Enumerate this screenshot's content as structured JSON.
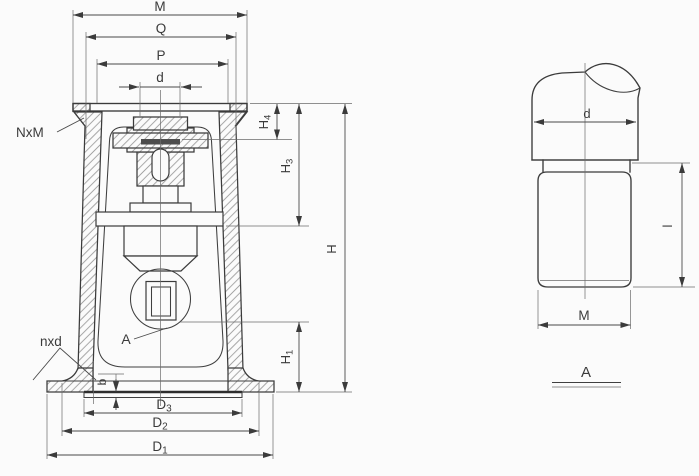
{
  "drawing": {
    "type": "engineering-section-drawing",
    "colors": {
      "background": "#fbfbfb",
      "line": "#3b3b3b",
      "dark_insert": "#4d4d4d",
      "hatch": "#8a8a8a"
    },
    "front_view": {
      "top_dims": {
        "m": "M",
        "q": "Q",
        "p": "P",
        "d": "d"
      },
      "right_dims": {
        "h4": {
          "base": "H",
          "sub": "4"
        },
        "h3": {
          "base": "H",
          "sub": "3"
        },
        "h": {
          "base": "H"
        },
        "h1": {
          "base": "H",
          "sub": "1"
        }
      },
      "bottom_dims": {
        "d3": {
          "base": "D",
          "sub": "3"
        },
        "d2": {
          "base": "D",
          "sub": "2"
        },
        "d1": {
          "base": "D",
          "sub": "1"
        }
      },
      "callouts": {
        "top_flange_holes": "NxM",
        "base_holes": "nxd",
        "detail_marker": "A",
        "pad_thickness": "b"
      }
    },
    "detail_view": {
      "title": "A",
      "dims": {
        "diameter": "d",
        "length": "l",
        "thread": "M"
      }
    }
  }
}
